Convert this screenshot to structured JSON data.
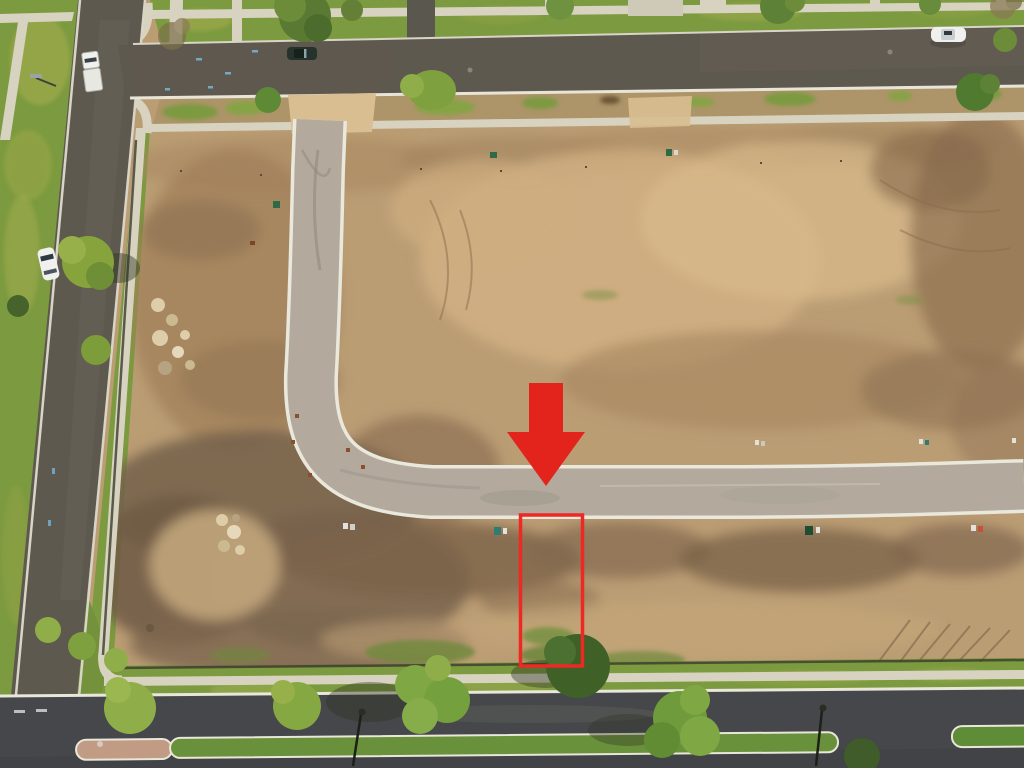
{
  "scene": {
    "description_label": "",
    "kind": "aerial-drone-photo-of-graded-residential-development"
  },
  "palette": {
    "dirt_base": "#bb9d74",
    "dirt_light": "#d2b284",
    "dirt_dark": "#8a6f52",
    "dirt_darker": "#6e5a45",
    "grass": "#7c9a3f",
    "grass_dark": "#5d7c31",
    "grass_light": "#9ab04b",
    "tree_dark": "#3f6128",
    "tree_light": "#86a83f",
    "asphalt_old": "#5d594f",
    "asphalt_boulevard": "#46474a",
    "concrete_new_road": "#b3aa9d",
    "curb_white": "#eae8dc",
    "sidewalk": "#d8d3c1",
    "median_brick": "#c29b85",
    "median_grass": "#69903a",
    "sand_apron": "#d8be90",
    "car_white": "#f0f1ee",
    "car_dark": "#26332c",
    "rock_light": "#ddcda9"
  },
  "annotations": {
    "arrow": {
      "name": "highlight-arrow",
      "color": "#e3241c"
    },
    "lot_outline": {
      "name": "highlighted-lot",
      "color": "#ee2822"
    }
  },
  "objects": {
    "vehicles": [
      {
        "label": "white-truck-with-trailer"
      },
      {
        "label": "dark-parked-car"
      },
      {
        "label": "white-parked-sedan"
      },
      {
        "label": "white-driving-car"
      }
    ],
    "roads": [
      {
        "label": "top-street"
      },
      {
        "label": "left-street"
      },
      {
        "label": "new-concrete-street"
      },
      {
        "label": "bottom-boulevard"
      }
    ]
  }
}
